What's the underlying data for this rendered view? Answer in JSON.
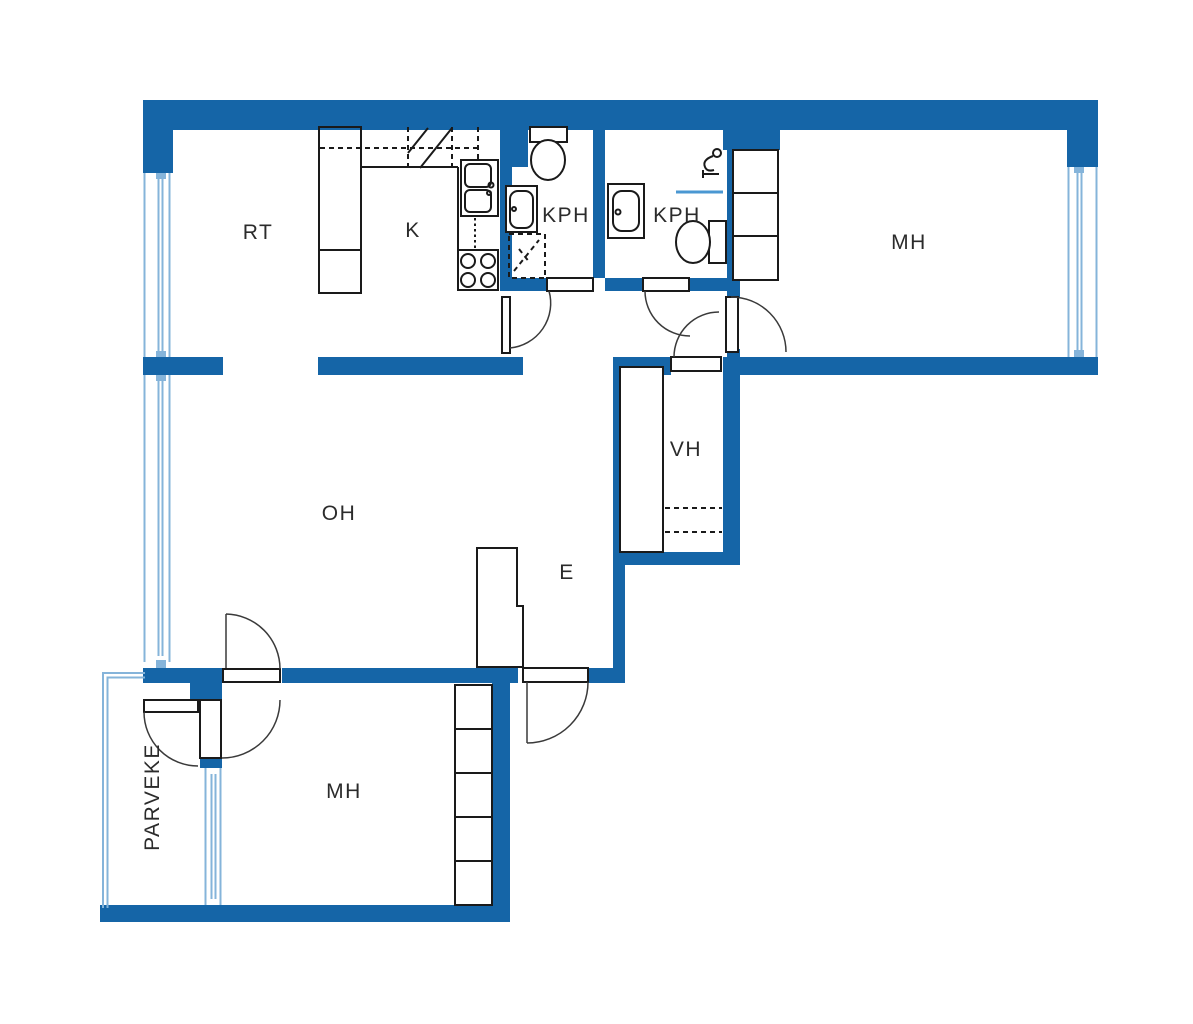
{
  "title": "Apartment floor plan",
  "rooms": [
    {
      "id": "rt",
      "label": "RT"
    },
    {
      "id": "k",
      "label": "K"
    },
    {
      "id": "kph-left",
      "label": "KPH"
    },
    {
      "id": "kph-right",
      "label": "KPH"
    },
    {
      "id": "mh-top",
      "label": "MH"
    },
    {
      "id": "vh",
      "label": "VH"
    },
    {
      "id": "oh",
      "label": "OH"
    },
    {
      "id": "e",
      "label": "E"
    },
    {
      "id": "mh-bottom",
      "label": "MH"
    },
    {
      "id": "parveke",
      "label": "PARVEKE"
    }
  ],
  "colors": {
    "wall": "#1565a7",
    "window": "#85b4da",
    "shower_line": "#4a97d2",
    "line": "#1a1a1a",
    "background": "#ffffff",
    "text": "#2b2b2b"
  }
}
